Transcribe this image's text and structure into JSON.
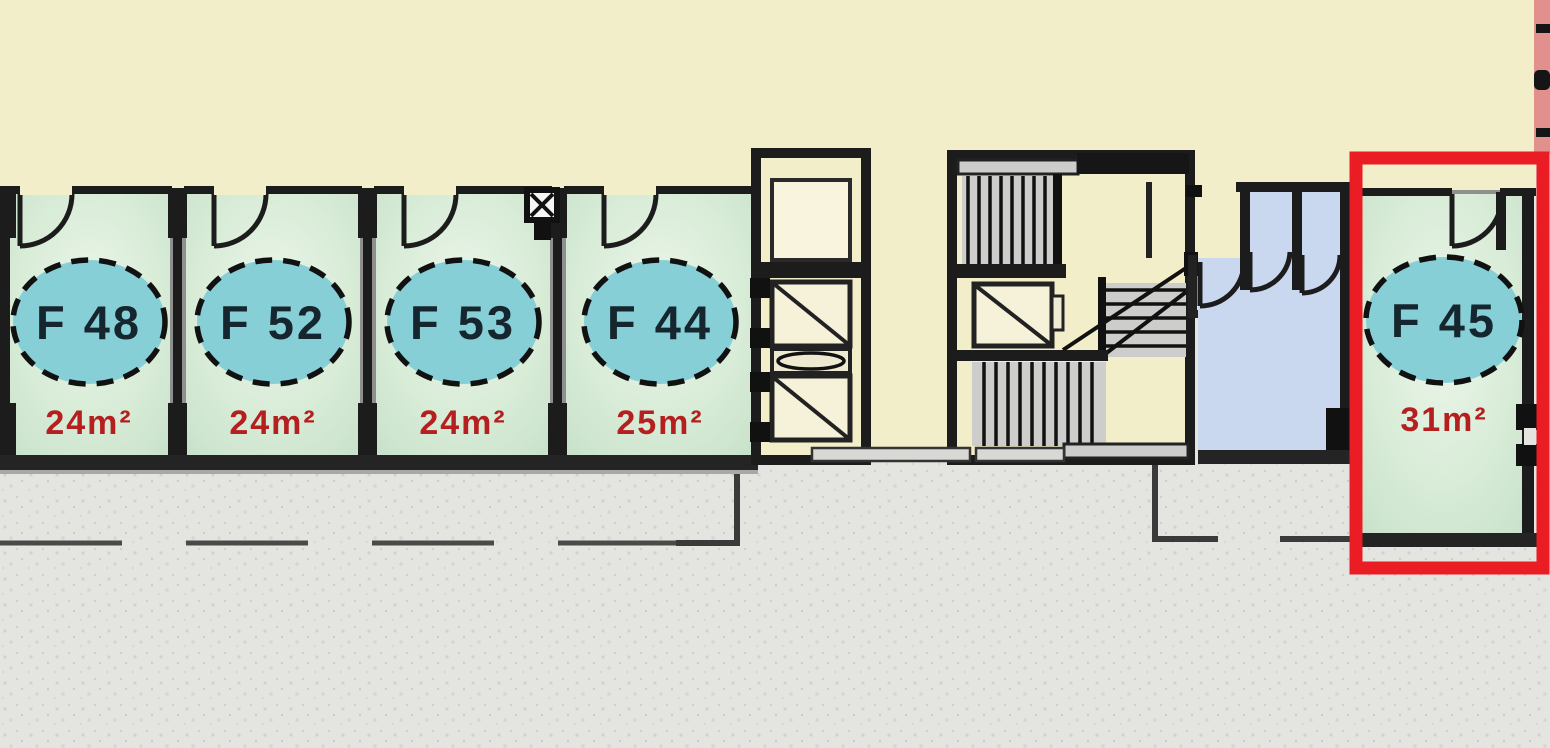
{
  "plan_type": "floor-plan",
  "units": [
    {
      "id": "F 48",
      "area": "24m²",
      "highlighted": false
    },
    {
      "id": "F 52",
      "area": "24m²",
      "highlighted": false
    },
    {
      "id": "F 53",
      "area": "24m²",
      "highlighted": false
    },
    {
      "id": "F 44",
      "area": "25m²",
      "highlighted": false
    },
    {
      "id": "F 45",
      "area": "31m²",
      "highlighted": true
    }
  ],
  "colors": {
    "highlight_box": "#ea1c24",
    "unit_badge_fill": "#86cfd6",
    "unit_label_text": "#16262e",
    "area_text": "#b51f1f",
    "room_fill_edge": "#c7e0c9",
    "corridor_fill": "#f2eeca",
    "wet_room_fill": "#c9d7ef",
    "exterior_fill": "#e4e4e1",
    "adjacent_building_fill": "#e2908e",
    "wall_color": "#1c1c1c"
  }
}
